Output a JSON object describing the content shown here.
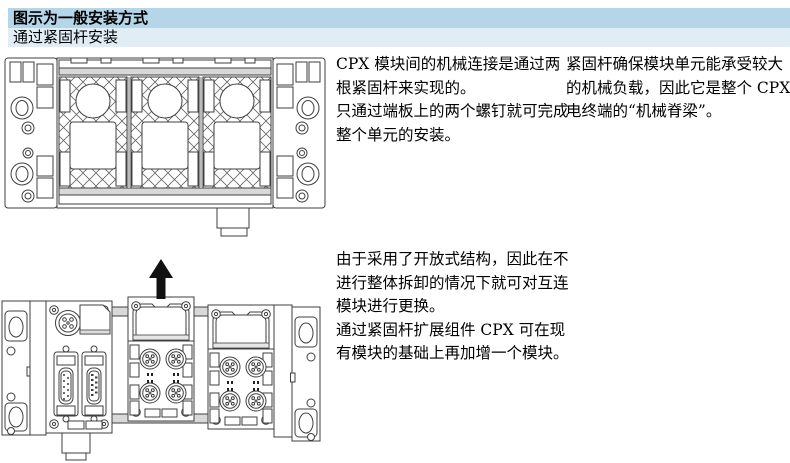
{
  "header": {
    "title_row": "图示为一般安装方式",
    "subtitle_row": "通过紧固杆安装"
  },
  "paragraphs": {
    "mechanical_connection": {
      "p1": "CPX 模块间的机械连接是通过两根紧固杆来实现的。",
      "p2": "只通过端板上的两个螺钉就可完成整个单元的安装。"
    },
    "tie_rod_backbone": {
      "p1": "紧固杆确保模块单元能承受较大的机械负载，因此它是整个 CPX 电终端的“机械脊梁”。"
    },
    "open_structure": {
      "p1": "由于采用了开放式结构，因此在不进行整体拆卸的情况下就可对互连模块进行更换。",
      "p2": "通过紧固杆扩展组件 CPX 可在现有模块的基础上再加增一个模块。"
    }
  },
  "icons": {
    "up_arrow": "↑"
  },
  "colors": {
    "header_bar_primary": "#b5d6e8",
    "header_bar_secondary": "#e0edf5",
    "line_art": "#3f3f3f",
    "rail_grey": "#d8d8d8",
    "arrow_black": "#111111"
  }
}
